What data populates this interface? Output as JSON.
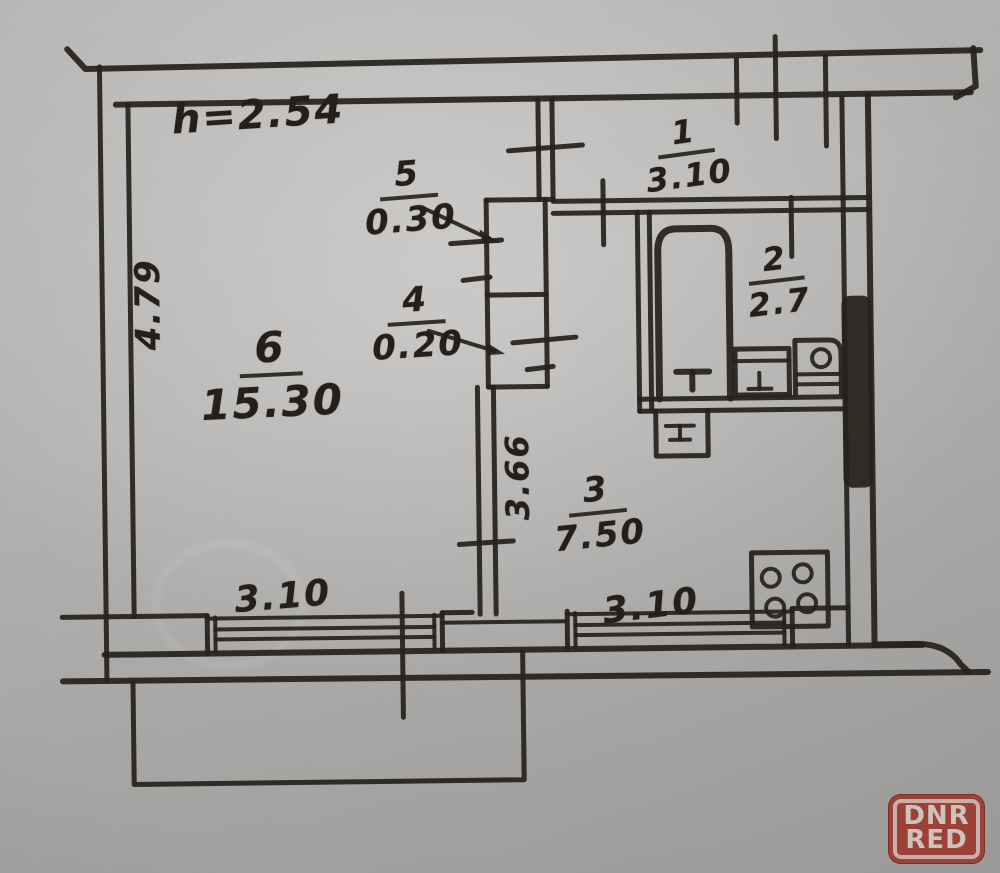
{
  "plan": {
    "ceiling_height": "h=2.54",
    "rooms": {
      "r1": {
        "number": "1",
        "area": "3.10"
      },
      "r2": {
        "number": "2",
        "area": "2.7"
      },
      "r3": {
        "number": "3",
        "area": "7.50"
      },
      "r4": {
        "number": "4",
        "area": "0.20"
      },
      "r5": {
        "number": "5",
        "area": "0.30"
      },
      "r6": {
        "number": "6",
        "area": "15.30"
      }
    },
    "dimensions": {
      "room6_height": "4.79",
      "hall_height": "3.66",
      "window_left": "3.10",
      "window_right": "3.10"
    },
    "ink_color": "#26211c",
    "paper_color": "#b1afad"
  },
  "watermark": {
    "line1": "DNR",
    "line2": "RED",
    "color": "#9c4038"
  }
}
